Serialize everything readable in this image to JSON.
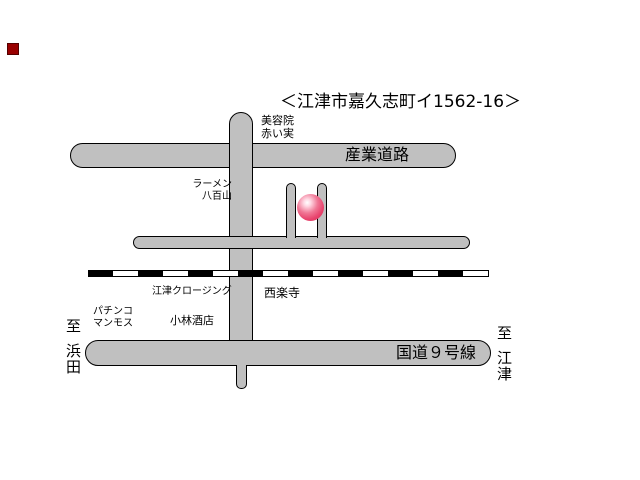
{
  "title": "＜江津市嘉久志町イ1562-16＞",
  "map": {
    "roads": {
      "sangyo_label": "産業道路",
      "route9_label": "国道９号線"
    },
    "places": {
      "beauty_salon": "美容院\n赤い実",
      "ramen": "ラーメン\n八百山",
      "clothing": "江津クロージング",
      "temple": "西楽寺",
      "pachinko": "パチンコ\nマンモス",
      "sake_shop": "小林酒店"
    },
    "directions": {
      "left": {
        "prefix": "至",
        "place": "浜田"
      },
      "right": {
        "prefix": "至",
        "place": "江津"
      }
    },
    "colors": {
      "road_fill": "#c0c0c0",
      "road_outline": "#000000",
      "marker_pink": "#e8426c",
      "railway_black": "#000000",
      "red_square": "#990000",
      "background": "#ffffff"
    }
  }
}
